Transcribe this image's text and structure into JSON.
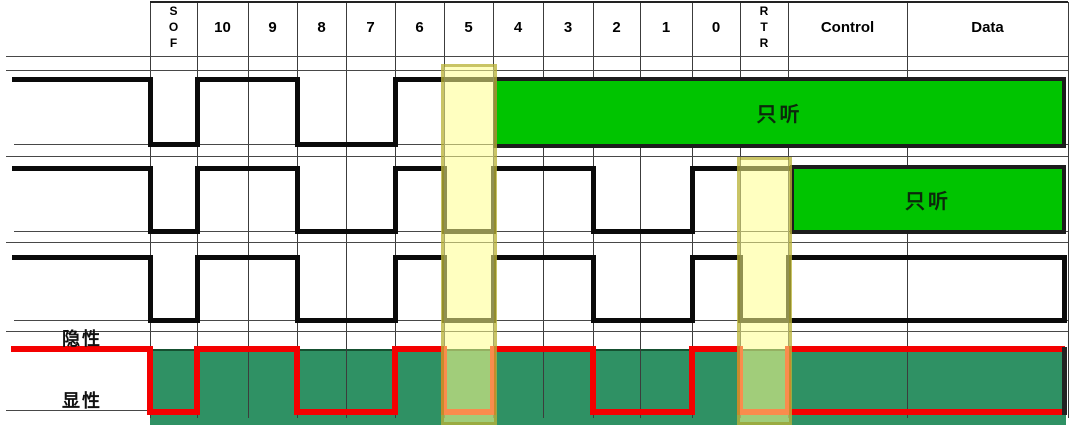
{
  "diagram": {
    "columns": [
      {
        "id": "SOF",
        "label": "SOF",
        "vertical": true
      },
      {
        "id": "10",
        "label": "10"
      },
      {
        "id": "9",
        "label": "9"
      },
      {
        "id": "8",
        "label": "8"
      },
      {
        "id": "7",
        "label": "7"
      },
      {
        "id": "6",
        "label": "6"
      },
      {
        "id": "5",
        "label": "5"
      },
      {
        "id": "4",
        "label": "4"
      },
      {
        "id": "3",
        "label": "3"
      },
      {
        "id": "2",
        "label": "2"
      },
      {
        "id": "1",
        "label": "1"
      },
      {
        "id": "0",
        "label": "0"
      },
      {
        "id": "RTR",
        "label": "RTR",
        "vertical": true
      },
      {
        "id": "Control",
        "label": "Control"
      },
      {
        "id": "Data",
        "label": "Data"
      }
    ],
    "levels": {
      "recessive_label": "隐性",
      "dominant_label": "显性"
    },
    "listen_only_label": "只听",
    "signals": [
      {
        "id": "node1",
        "bits": {
          "SOF": 0,
          "10": 1,
          "9": 1,
          "8": 0,
          "7": 0,
          "6": 1,
          "5": 1
        },
        "listen_only_from": "4"
      },
      {
        "id": "node2",
        "bits": {
          "SOF": 0,
          "10": 1,
          "9": 1,
          "8": 0,
          "7": 0,
          "6": 1,
          "5": 0,
          "4": 1,
          "3": 1,
          "2": 0,
          "1": 0,
          "0": 1,
          "RTR": 1
        },
        "listen_only_from": "Control"
      },
      {
        "id": "node3",
        "bits": {
          "SOF": 0,
          "10": 1,
          "9": 1,
          "8": 0,
          "7": 0,
          "6": 1,
          "5": 0,
          "4": 1,
          "3": 1,
          "2": 0,
          "1": 0,
          "0": 1,
          "RTR": 0
        },
        "frame_box_from": "Control"
      },
      {
        "id": "bus",
        "bits": {
          "SOF": 0,
          "10": 1,
          "9": 1,
          "8": 0,
          "7": 0,
          "6": 1,
          "5": 0,
          "4": 1,
          "3": 1,
          "2": 0,
          "1": 0,
          "0": 1,
          "RTR": 0
        },
        "frame_box_from": "Control"
      }
    ],
    "highlights": [
      {
        "column": "5"
      },
      {
        "column": "RTR"
      }
    ],
    "colors": {
      "waveform": "#0a0a0a",
      "bus_waveform": "#f40000",
      "listen_box_fill": "#00c400",
      "listen_box_border": "#1c1c1c",
      "bus_fill": "#2f9164",
      "highlight_fill": "rgba(255,255,140,0.55)",
      "highlight_border": "rgba(148,138,10,0.5)",
      "grid": "#3c3c3c"
    }
  }
}
